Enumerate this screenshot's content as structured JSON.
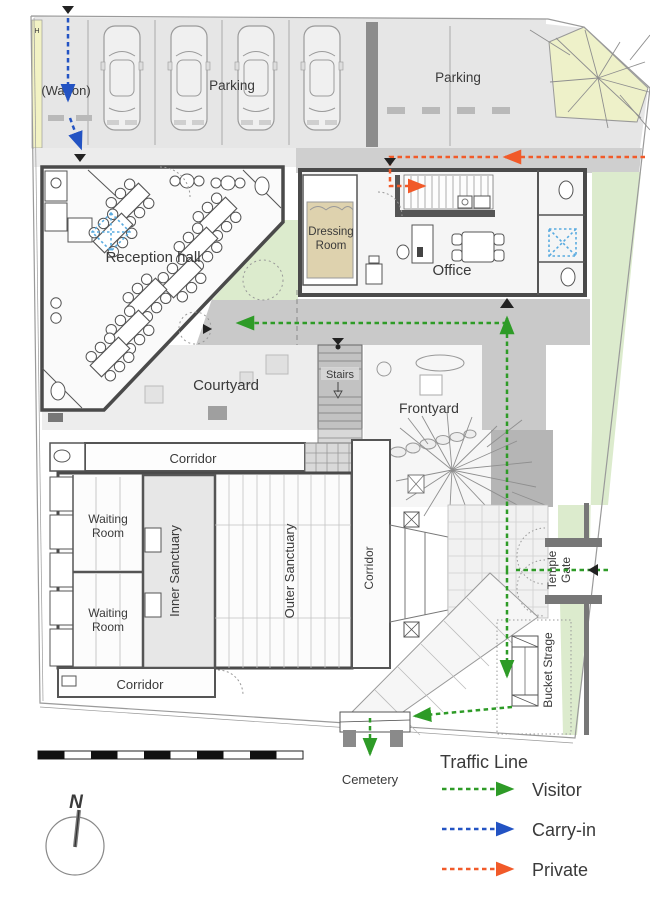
{
  "plan": {
    "areas": {
      "wagon": "(Wagon)",
      "parking_left": "Parking",
      "parking_right": "Parking",
      "reception_hall": "Reception hall",
      "dressing_room": [
        "Dressing",
        "Room"
      ],
      "office": "Office",
      "courtyard": "Courtyard",
      "stairs": "Stairs",
      "frontyard": "Frontyard",
      "corridor_top": "Corridor",
      "corridor_bottom": "Corridor",
      "corridor_right": "Corridor",
      "waiting_room_upper": [
        "Waiting",
        "Room"
      ],
      "waiting_room_lower": [
        "Waiting",
        "Room"
      ],
      "inner_sanctuary": "Inner Sanctuary",
      "outer_sanctuary": "Outer Sanctuary",
      "temple_gate": [
        "Temple",
        "Gate"
      ],
      "bucket_storage": "Bucket Strage",
      "cemetery": "Cemetery"
    },
    "markers": {
      "north": "N",
      "hydrant": "H"
    }
  },
  "legend": {
    "title": "Traffic Line",
    "items": [
      {
        "label": "Visitor",
        "color": "#2e9b27"
      },
      {
        "label": "Carry-in",
        "color": "#2353c3"
      },
      {
        "label": "Private",
        "color": "#f15a29"
      }
    ]
  },
  "colors": {
    "cemetery_label": "#7d3a33",
    "wall": "#4a4a4a",
    "parking_gray": "#e6e6e6",
    "walkway_gray": "#c9c9c9",
    "green_strip": "#dcebcd",
    "grove": "#eef1c9",
    "dressing_tan": "#ded2ae",
    "skylight_blue": "#5aabe0"
  }
}
